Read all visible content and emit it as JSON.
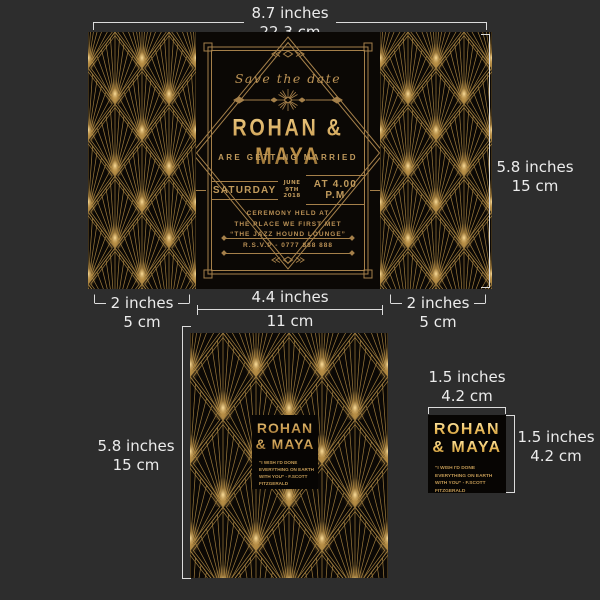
{
  "annotations": {
    "top_width_in": "8.7 inches",
    "top_width_cm": "22.3 cm",
    "front_height_in": "5.8 inches",
    "front_height_cm": "15 cm",
    "flap_left_in": "2 inches",
    "flap_left_cm": "5 cm",
    "center_width_in": "4.4 inches",
    "center_width_cm": "11 cm",
    "flap_right_in": "2 inches",
    "flap_right_cm": "5 cm",
    "back_height_in": "5.8 inches",
    "back_height_cm": "15 cm",
    "tag_width_in": "1.5 inches",
    "tag_width_cm": "4.2 cm",
    "tag_height_in": "1.5 inches",
    "tag_height_cm": "4.2 cm"
  },
  "front": {
    "save_the_date": "Save the date",
    "names": "ROHAN & MAYA",
    "subtitle": "ARE GETTING MARRIED",
    "day": "SATURDAY",
    "month": "JUNE",
    "day_num": "9TH",
    "year": "2018",
    "time": "AT 4.00 P.M",
    "venue1": "CEREMONY HELD AT",
    "venue2": "THE PLACE WE FIRST MET",
    "venue3": "“THE JAZZ HOUND LOUNGE”",
    "rsvp": "R.S.V.P - 0777 888 888"
  },
  "back": {
    "name1": "ROHAN",
    "name2": "& MAYA",
    "quote1": "“I WISH I'D DONE",
    "quote2": "EVERYTHING ON EARTH",
    "quote3": "WITH YOU” - F.SCOTT FITZGERALD"
  },
  "tag": {
    "name1": "ROHAN",
    "name2": "& MAYA",
    "quote1": "“I WISH I'D DONE",
    "quote2": "EVERYTHING ON EARTH",
    "quote3": "WITH YOU” - F.SCOTT FITZGERALD"
  },
  "colors": {
    "background": "#2d2d2d",
    "card_black": "#0b0805",
    "gold": "#c09a5c",
    "pattern_gold": "#9c7a3c",
    "bright_gold": "#ffe2a0",
    "annotation": "#ececec"
  }
}
